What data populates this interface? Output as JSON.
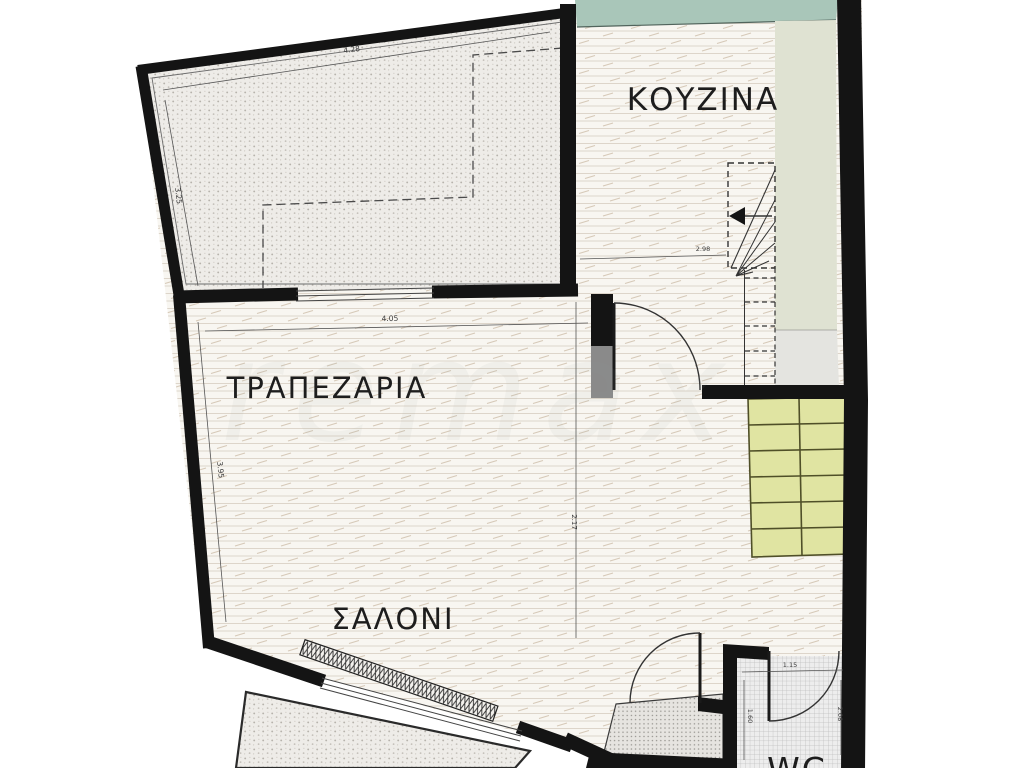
{
  "plan": {
    "type": "floor-plan",
    "rooms": {
      "kitchen": {
        "label": "ΚΟΥΖΙΝΑ"
      },
      "dining": {
        "label": "ΤΡΑΠΕΖΑΡΙΑ"
      },
      "living": {
        "label": "ΣΑΛΟΝΙ"
      },
      "wc": {
        "label": "WC"
      }
    },
    "dims": {
      "terrace_top": "4.28",
      "terrace_left": "3.25",
      "dining_top": "4.05",
      "dining_left": "3.95",
      "living_right": "2.17",
      "kitchen_bottom": "2.98",
      "wc_top": "1.15",
      "wc_left": "1.60",
      "wc_right": "2.08"
    },
    "stairs": {
      "visible_steps": 6,
      "direction_arrow": "left",
      "winder": true
    },
    "icons": {
      "stair_arrow": "left-arrow",
      "doors": "quarter-arc-swing"
    },
    "colors": {
      "wall": "#141414",
      "teal_counter": "#a9c6b9",
      "sage_strip": "#dfe2d2",
      "gray_block": "#e4e4e0",
      "stair_fill": "#e0e4a2",
      "stair_line": "#4f4f28",
      "landing_gray": "#e6e4e0"
    },
    "watermark": "remax"
  }
}
